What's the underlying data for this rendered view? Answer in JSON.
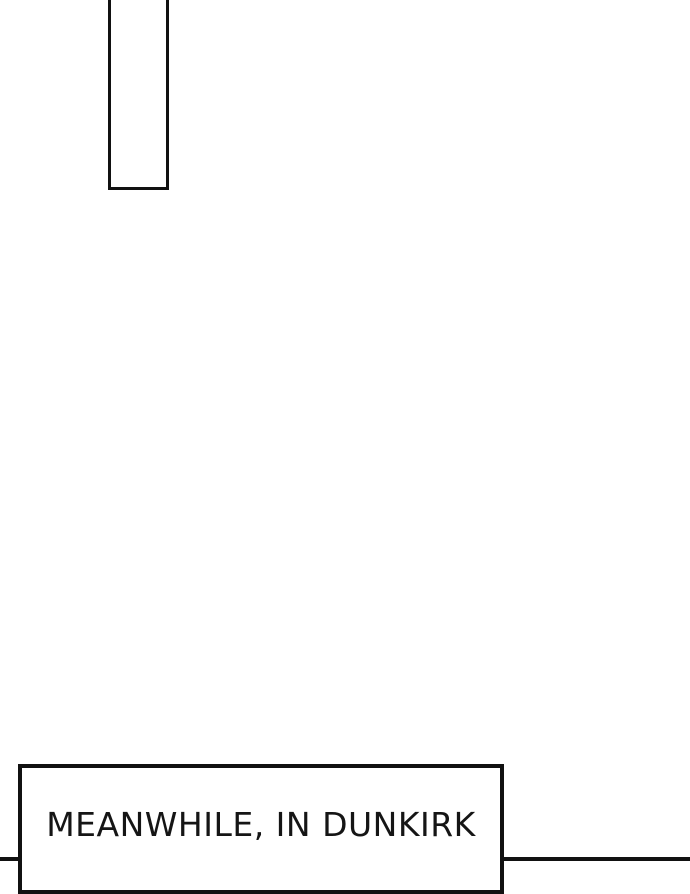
{
  "page": {
    "background_color": "#ffffff",
    "line_color": "#111111",
    "text_color": "#151515"
  },
  "caption": {
    "text": "MEANWHILE, IN DUNKIRK"
  }
}
